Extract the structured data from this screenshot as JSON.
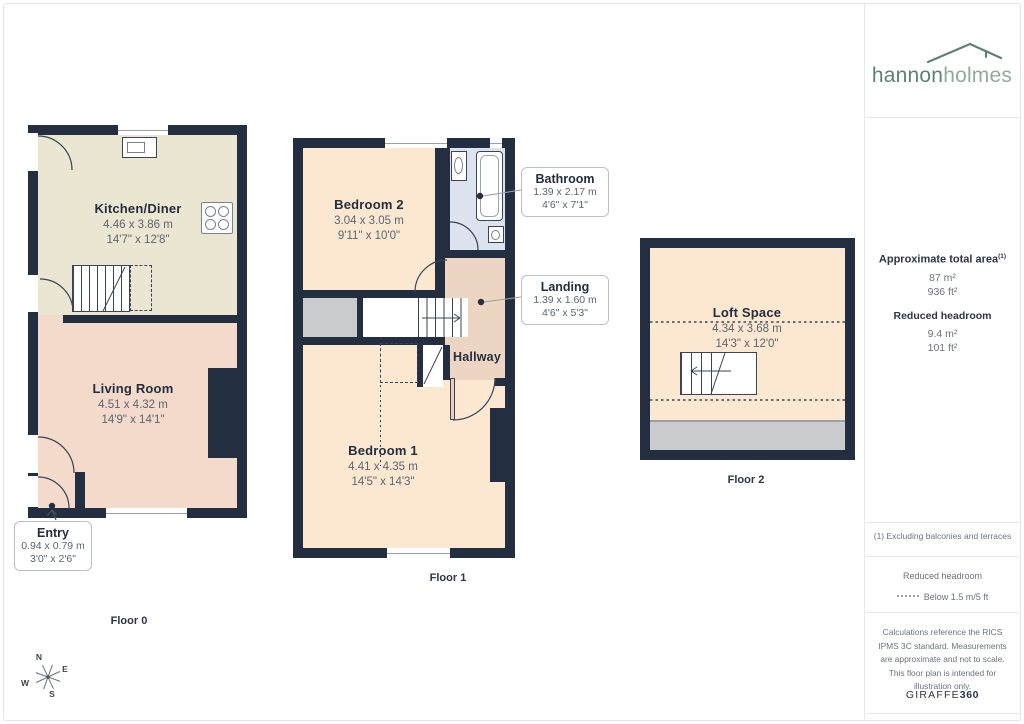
{
  "brand": {
    "logo_text_1": "hannon",
    "logo_text_2": "holmes",
    "footer_brand_1": "GIRAFFE",
    "footer_brand_2": "360"
  },
  "sidebar": {
    "total_area_label": "Approximate total area",
    "total_area_footnote_marker": "(1)",
    "total_area_metric": "87 m²",
    "total_area_imperial": "936 ft²",
    "reduced_headroom_label": "Reduced headroom",
    "reduced_headroom_metric": "9.4 m²",
    "reduced_headroom_imperial": "101 ft²",
    "footnote": "(1) Excluding balconies and terraces",
    "legend_title": "Reduced headroom",
    "legend_value": "Below 1.5 m/5 ft",
    "disclaimer": "Calculations reference the RICS IPMS 3C standard. Measurements are approximate and not to scale. This floor plan is intended for illustration only."
  },
  "floors": {
    "floor0": {
      "label": "Floor 0",
      "rooms": {
        "kitchen": {
          "name": "Kitchen/Diner",
          "dim_m": "4.46 x 3.86 m",
          "dim_ft": "14'7\" x 12'8\""
        },
        "living": {
          "name": "Living Room",
          "dim_m": "4.51 x 4.32 m",
          "dim_ft": "14'9\" x 14'1\""
        }
      },
      "callouts": {
        "entry": {
          "name": "Entry",
          "dim_m": "0.94 x 0.79 m",
          "dim_ft": "3'0\" x 2'6\""
        }
      }
    },
    "floor1": {
      "label": "Floor 1",
      "rooms": {
        "bedroom2": {
          "name": "Bedroom 2",
          "dim_m": "3.04 x 3.05 m",
          "dim_ft": "9'11\" x 10'0\""
        },
        "hallway": {
          "name": "Hallway"
        },
        "bedroom1": {
          "name": "Bedroom 1",
          "dim_m": "4.41 x 4.35 m",
          "dim_ft": "14'5\" x 14'3\""
        }
      },
      "callouts": {
        "bathroom": {
          "name": "Bathroom",
          "dim_m": "1.39 x 2.17 m",
          "dim_ft": "4'6\" x 7'1\""
        },
        "landing": {
          "name": "Landing",
          "dim_m": "1.39 x 1.60 m",
          "dim_ft": "4'6\" x 5'3\""
        }
      }
    },
    "floor2": {
      "label": "Floor 2",
      "rooms": {
        "loft": {
          "name": "Loft Space",
          "dim_m": "4.34 x 3.68 m",
          "dim_ft": "14'3\" x 12'0\""
        }
      }
    }
  },
  "compass": {
    "north": "N",
    "east": "E",
    "south": "S",
    "west": "W"
  },
  "colors": {
    "wall": "#232e40",
    "kitchen": "#ebe6d2",
    "living": "#f3dacb",
    "bedroom": "#fce8d1",
    "hall": "#edd5c3",
    "bathroom": "#dce2ee",
    "headroom-grey": "#cacbcc",
    "brand-green": "#5d8175",
    "brand-green-light": "#92aa9d"
  }
}
